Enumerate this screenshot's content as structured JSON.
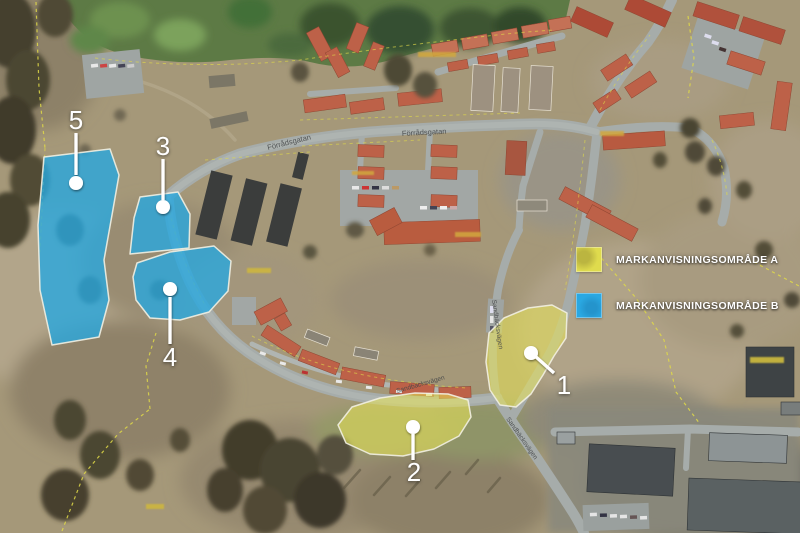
{
  "map": {
    "description": "Aerial orthophoto with land-allocation overlay areas",
    "legend": {
      "items": [
        {
          "id": "A",
          "label": "MARKANVISNINGSOMRÅDE A",
          "color": "#dfdb4d"
        },
        {
          "id": "B",
          "label": "MARKANVISNINGSOMRÅDE B",
          "color": "#2aa8e2"
        }
      ]
    },
    "areas": {
      "a1": {
        "number": "1",
        "category": "A",
        "fill": "#e9e657"
      },
      "a2": {
        "number": "2",
        "category": "A",
        "fill": "#e9e657"
      },
      "a3": {
        "number": "3",
        "category": "B",
        "fill": "#28a7df"
      },
      "a4": {
        "number": "4",
        "category": "B",
        "fill": "#28a7df"
      },
      "a5": {
        "number": "5",
        "category": "B",
        "fill": "#28a7df"
      }
    },
    "streets": {
      "top_west": "Förrådsgatan",
      "top_east": "Förrådsgatan",
      "arc": "Sandbäcksvägen",
      "north_south": "Sandbäcksvägen",
      "southeast": "Sandbäcksvägen"
    },
    "colors": {
      "marker": "#ffffff",
      "area_a_fill": "#e9e657",
      "area_b_fill": "#28a7df",
      "cadastral_line": "#e0da48"
    }
  }
}
